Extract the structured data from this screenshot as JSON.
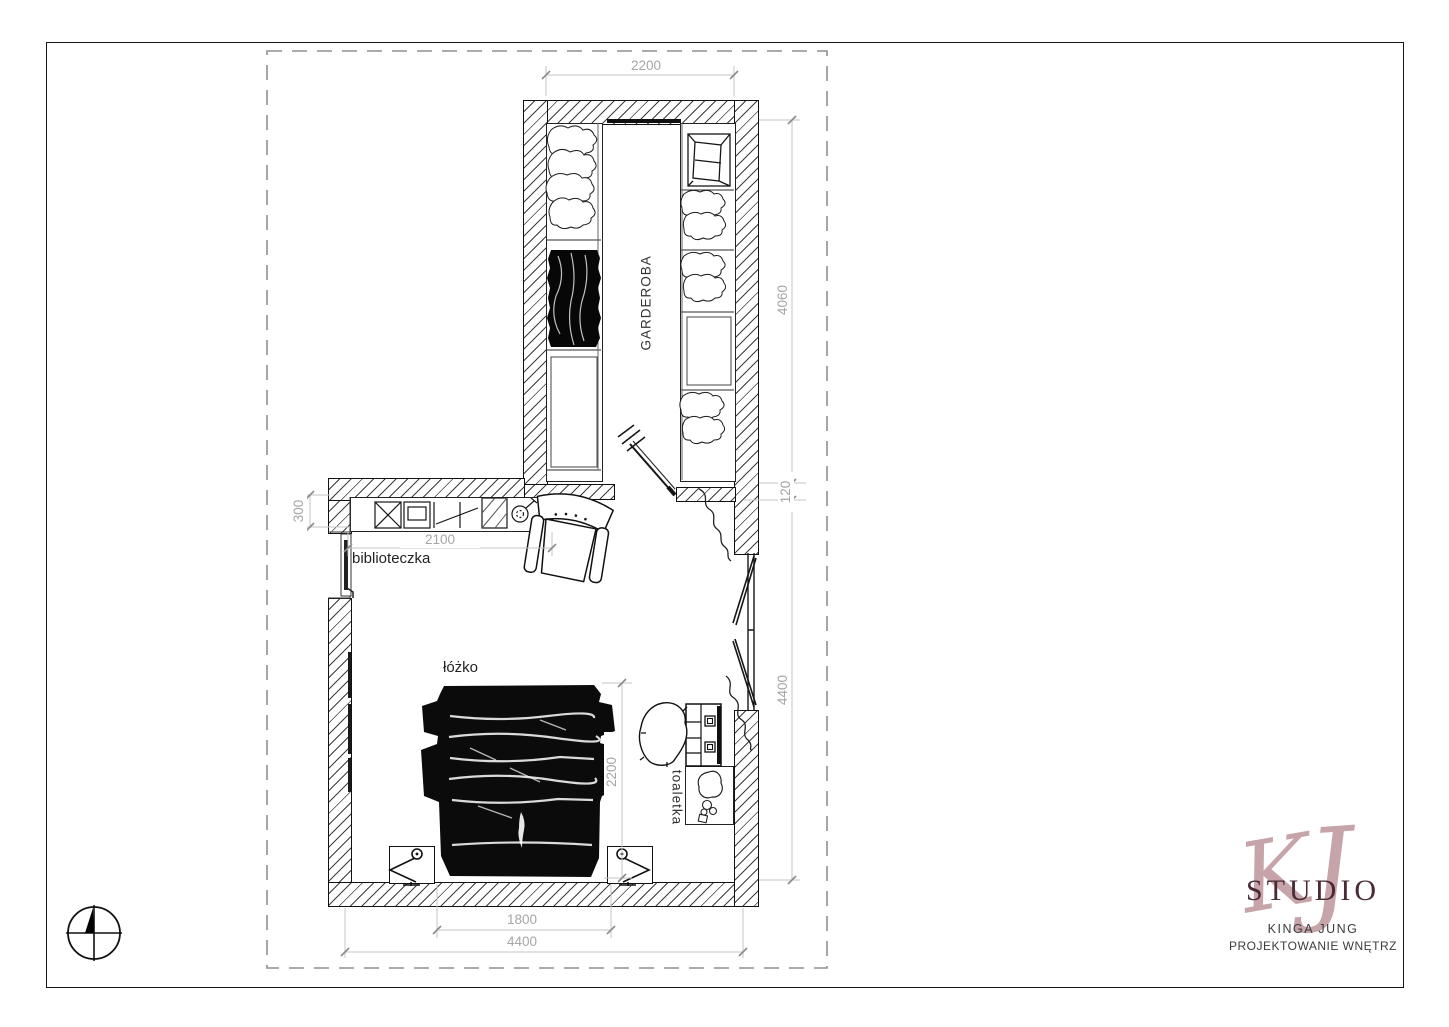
{
  "document": {
    "type": "interior floor plan"
  },
  "plan": {
    "rooms": {
      "wardrobe_label": "GARDEROBA"
    },
    "furniture_labels": {
      "bookcase": "biblioteczka",
      "bed": "łóżko",
      "vanity": "toaletka"
    },
    "dimensions": {
      "wardrobe_width": "2200",
      "wardrobe_length": "4060",
      "partition_thickness": "120",
      "bedroom_length": "4400",
      "bookcase_depth": "300",
      "bookcase_run": "2100",
      "bed_length": "2200",
      "bed_width": "1800",
      "bedroom_width": "4400"
    },
    "colors": {
      "dimension_gray": "#a6a6a6",
      "line_black": "#1a1a1a"
    }
  },
  "logo": {
    "monogram_k": "K",
    "monogram_j": "J",
    "studio_label": "STUDIO",
    "designer_name": "KINGA JUNG",
    "tagline": "PROJEKTOWANIE WNĘTRZ",
    "accent_color": "#c7a4a9",
    "studio_color": "#4a2b35"
  },
  "icons": {
    "north_compass": "north-compass-icon"
  }
}
